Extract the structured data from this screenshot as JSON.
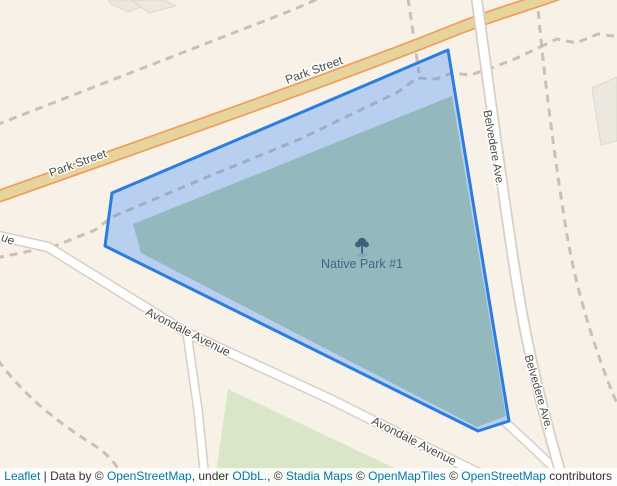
{
  "map": {
    "poi": {
      "name": "Native Park #1",
      "icon": "tree-icon"
    },
    "road_labels": {
      "park_street": "Park Street",
      "belvedere": "Belvedere Ave.",
      "avondale": "Avondale Avenue",
      "avenue_fragment": "ue"
    }
  },
  "colors": {
    "background": "#f8f1e7",
    "polygon_stroke": "#2b7de0",
    "polygon_fill": "#3388ff",
    "park_base": "#c2cfa0",
    "grass": "#d9e7c8",
    "road_primary_fill": "#e7d49c",
    "road_primary_casing": "#ef9f5e",
    "road_minor_fill": "#ffffff",
    "road_minor_casing": "#d6cfc5",
    "footpath": "#cfbfae",
    "building": "#ece8e0",
    "road_label_text": "#4c4c46",
    "poi_label_text": "#3e6a80",
    "attribution_link": "#0078A8"
  },
  "attribution": {
    "parts": [
      {
        "text": "Leaflet",
        "link": true
      },
      {
        "text": " | Data by © ",
        "link": false
      },
      {
        "text": "OpenStreetMap",
        "link": true
      },
      {
        "text": ", under ",
        "link": false
      },
      {
        "text": "ODbL.",
        "link": true
      },
      {
        "text": ", © ",
        "link": false
      },
      {
        "text": "Stadia Maps",
        "link": true
      },
      {
        "text": " © ",
        "link": false
      },
      {
        "text": "OpenMapTiles",
        "link": true
      },
      {
        "text": " © ",
        "link": false
      },
      {
        "text": "OpenStreetMap",
        "link": true
      },
      {
        "text": " contributors",
        "link": false
      }
    ]
  }
}
